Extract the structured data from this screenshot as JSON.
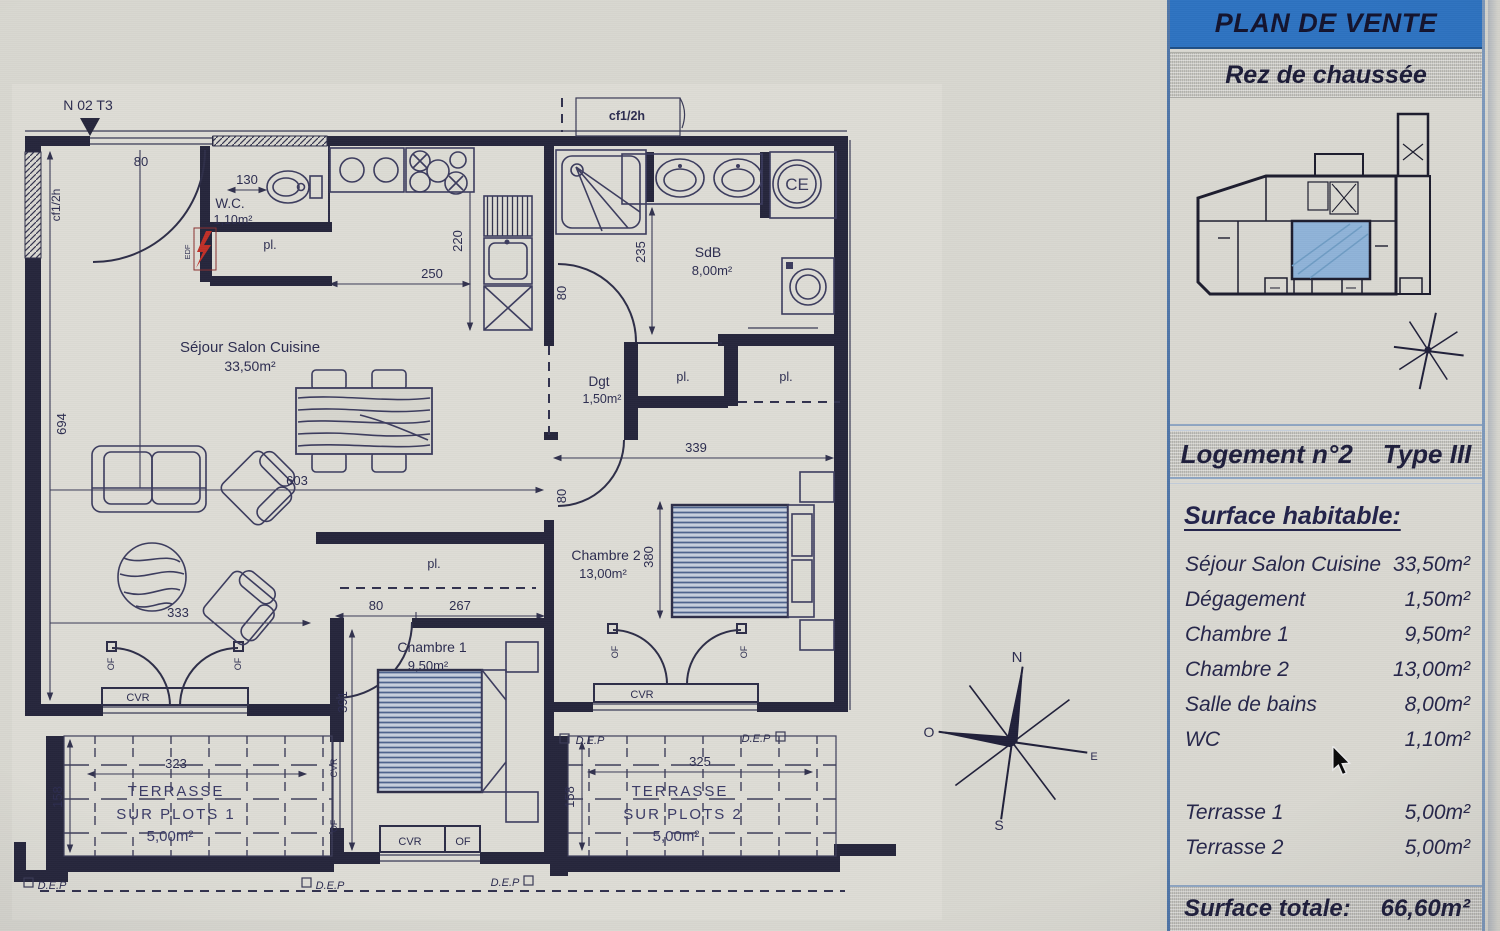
{
  "panel": {
    "title": "PLAN DE VENTE",
    "floor": "Rez de chaussée",
    "unit": "Logement n°2",
    "unit_type": "Type III",
    "section_title": "Surface habitable:",
    "rooms": [
      {
        "name": "Séjour Salon Cuisine",
        "area": "33,50m²"
      },
      {
        "name": "Dégagement",
        "area": "1,50m²"
      },
      {
        "name": "Chambre 1",
        "area": "9,50m²"
      },
      {
        "name": "Chambre 2",
        "area": "13,00m²"
      },
      {
        "name": "Salle de bains",
        "area": "8,00m²"
      },
      {
        "name": "WC",
        "area": "1,10m²"
      }
    ],
    "terraces": [
      {
        "name": "Terrasse 1",
        "area": "5,00m²"
      },
      {
        "name": "Terrasse 2",
        "area": "5,00m²"
      }
    ],
    "total_label": "Surface totale:",
    "total_value": "66,60m²",
    "accent_color": "#2e73c1",
    "key_unit_color": "#8fb3d8"
  },
  "plan": {
    "unit_marker": "N 02 T3",
    "rooms": {
      "sejour": {
        "name": "Séjour Salon Cuisine",
        "area": "33,50m²"
      },
      "wc": {
        "name": "W.C.",
        "area": "1,10m²"
      },
      "sdb": {
        "name": "SdB",
        "area": "8,00m²"
      },
      "dgt": {
        "name": "Dgt",
        "area": "1,50m²"
      },
      "ch1": {
        "name": "Chambre 1",
        "area": "9,50m²"
      },
      "ch2": {
        "name": "Chambre 2",
        "area": "13,00m²"
      },
      "t1": {
        "l1": "TERRASSE",
        "l2": "SUR PLOTS 1",
        "area": "5,00m²"
      },
      "t2": {
        "l1": "TERRASSE",
        "l2": "SUR PLOTS 2",
        "area": "5,00m²"
      }
    },
    "dims": {
      "top_window": "80",
      "wc": "130",
      "kitchen_w": "250",
      "kitchen_h": "220",
      "sdb_h": "235",
      "sdb_door": "80",
      "ch2_w": "339",
      "ch2_door": "80",
      "ch2_h": "380",
      "liv_h": "694",
      "liv_w": "603",
      "liv_w2": "333",
      "ch1_door": "80",
      "ch1_w": "267",
      "ch1_h": "391",
      "t1_w": "323",
      "t1_h": "158",
      "t2_w": "325",
      "t2_h": "158"
    },
    "tags": {
      "cf": "cf1/2h",
      "pl": "pl.",
      "cvr": "CVR",
      "of": "OF",
      "dep": "D.E.P",
      "edf": "EDF",
      "ce": "CE"
    },
    "compass": {
      "n": "N",
      "s": "S",
      "e": "E",
      "o": "O"
    }
  }
}
